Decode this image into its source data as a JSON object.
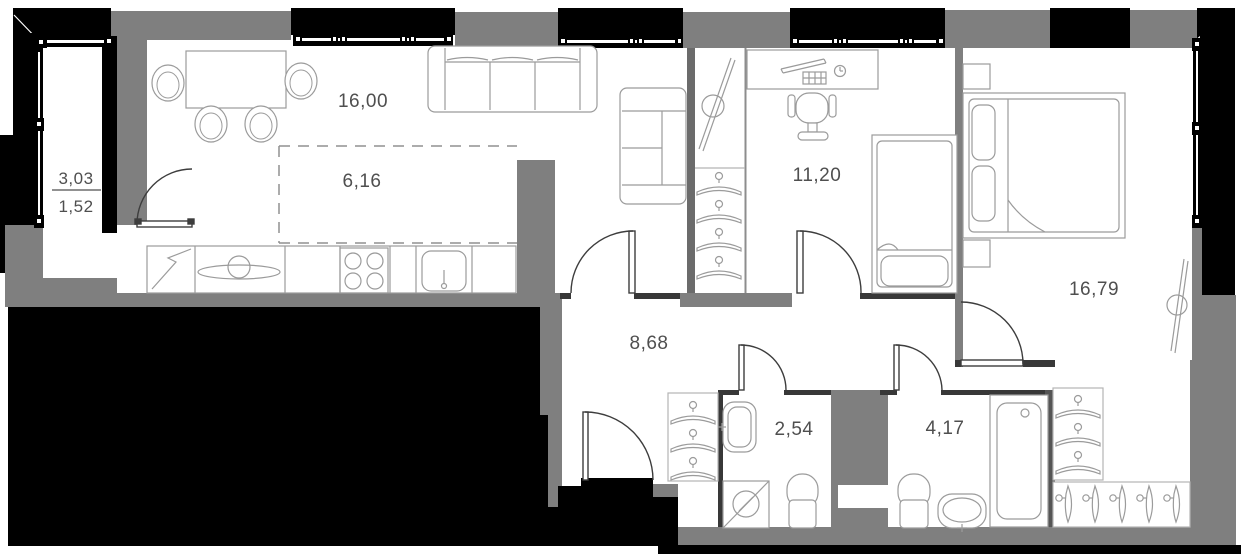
{
  "plan": {
    "title": "apartment floor plan",
    "rooms": {
      "balcony": {
        "area_total": "3,03",
        "area_counted": "1,52"
      },
      "living_kitchen": {
        "area": "16,00"
      },
      "kitchen_zone": {
        "area": "6,16"
      },
      "bedroom": {
        "area": "11,20"
      },
      "master_bedroom": {
        "area": "16,79"
      },
      "hallway": {
        "area": "8,68"
      },
      "bathroom_small": {
        "area": "2,54"
      },
      "bathroom_large": {
        "area": "4,17"
      }
    },
    "colors": {
      "exterior_wall_black": "#000000",
      "exterior_wall_gray": "#7f7f7f",
      "interior_wall_dark": "#383838",
      "room_fill": "#ffffff",
      "furniture_stroke": "#9b9b9b",
      "light_border": "#b4b4b4",
      "door_stroke": "#3d3d3d",
      "label_text": "#4f4f4f"
    },
    "icons": [
      "dining-table-icon",
      "chair-icon",
      "sofa-3seat-icon",
      "sofa-2seat-icon",
      "tv-icon",
      "fridge-icon",
      "sink-icon",
      "stove-icon",
      "kitchen-sink-icon",
      "desk-icon",
      "keyboard-icon",
      "monitor-icon",
      "office-chair-icon",
      "clock-icon",
      "single-bed-icon",
      "double-bed-icon",
      "pillow-icon",
      "nightstand-icon",
      "hanger-icon",
      "hanger-side-icon",
      "washing-machine-icon",
      "toilet-icon",
      "washbasin-icon",
      "bathtub-icon",
      "door-swing-icon",
      "window-icon"
    ]
  }
}
